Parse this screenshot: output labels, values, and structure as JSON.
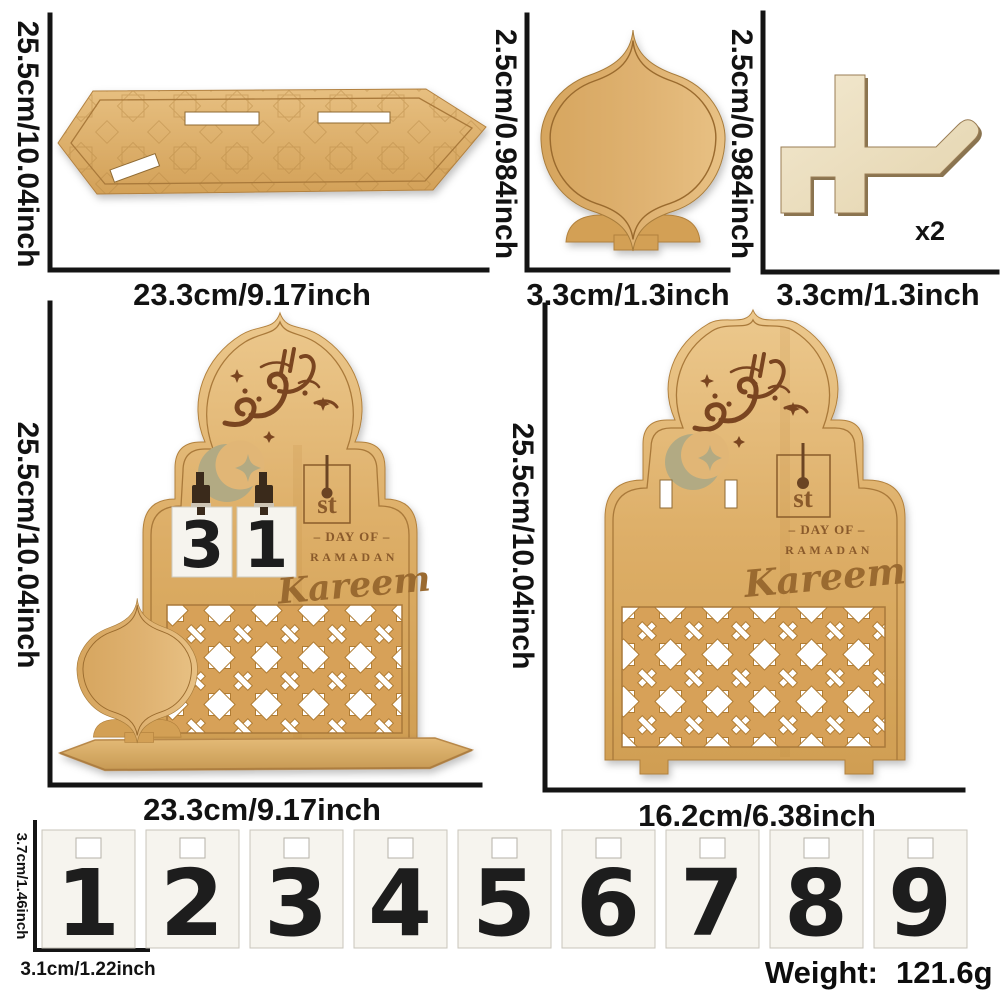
{
  "page": {
    "background": "#ffffff",
    "dimension_line_color": "#141414"
  },
  "colors": {
    "wood": "#dcab63",
    "wood_light": "#e9c286",
    "wood_dark": "#d09e52",
    "plywood": "#f0e5c9",
    "engraving_brown": "#8a5a2b",
    "calligraphy_brown": "#7a4520",
    "crescent_olive": "#b2aa83",
    "card_bg": "#f6f4ee",
    "clip_brown": "#3a2a1b",
    "number_color": "#1d1d1d"
  },
  "sections": {
    "base_plank": {
      "height_label": "25.5cm/10.04inch",
      "width_label": "23.3cm/9.17inch"
    },
    "lantern_piece": {
      "height_label": "2.5cm/0.984inch",
      "width_label": "3.3cm/1.3inch"
    },
    "hook_piece": {
      "height_label": "2.5cm/0.984inch",
      "width_label": "3.3cm/1.3inch",
      "quantity": "x2"
    },
    "calendar_front": {
      "height_label": "25.5cm/10.04inch",
      "width_label": "23.3cm/9.17inch",
      "cards": [
        "3",
        "1"
      ],
      "engraving": {
        "suffix": "st",
        "day_of": "– DAY OF –",
        "ramadan": "RAMADAN",
        "kareem": "Kareem"
      }
    },
    "calendar_back": {
      "height_label": "25.5cm/10.04inch",
      "width_label": "16.2cm/6.38inch",
      "engraving": {
        "suffix": "st",
        "day_of": "– DAY OF –",
        "ramadan": "RAMADAN",
        "kareem": "Kareem"
      }
    },
    "number_cards": {
      "height_label": "3.7cm/1.46inch",
      "width_label": "3.1cm/1.22inch",
      "numbers": [
        "1",
        "2",
        "3",
        "4",
        "5",
        "6",
        "7",
        "8",
        "9"
      ]
    },
    "weight": {
      "label": "Weight:",
      "value": "121.6g"
    }
  }
}
